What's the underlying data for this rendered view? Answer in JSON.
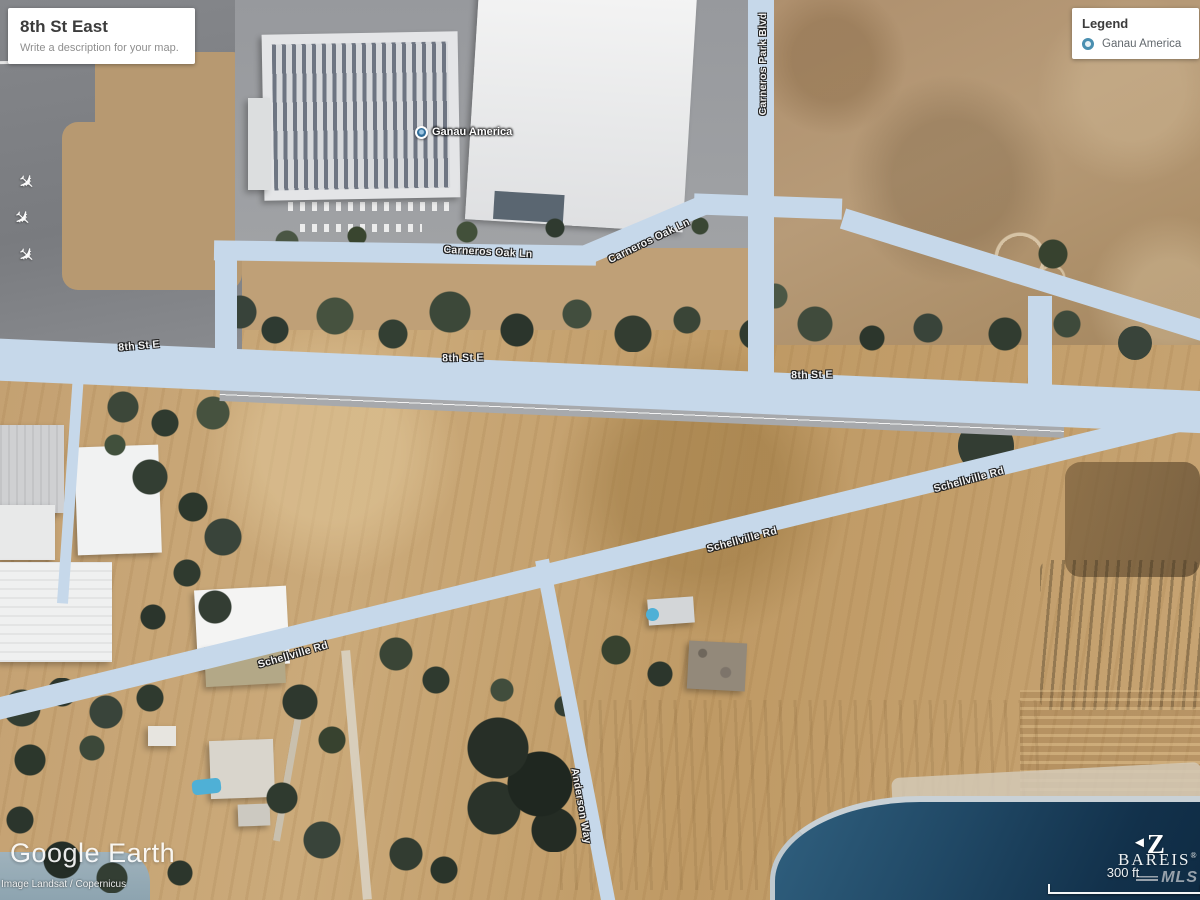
{
  "title_card": {
    "title": "8th St East",
    "subtitle": "Write a description for your map."
  },
  "legend": {
    "title": "Legend",
    "items": [
      {
        "label": "Ganau America",
        "marker_color": "#4a8fb0"
      }
    ]
  },
  "map": {
    "marker_label": "Ganau America",
    "road_labels": {
      "carneros_oak_w": "Carneros Oak Ln",
      "carneros_oak_e": "Carneros Oak Ln",
      "carneros_park_blvd": "Carneros Park Blvd",
      "eighth_w": "8th St E",
      "eighth_m": "8th St E",
      "eighth_e": "8th St E",
      "schellville_e": "Schellville Rd",
      "schellville_m": "Schellville Rd",
      "schellville_w": "Schellville Rd",
      "anderson": "Anderson Way"
    }
  },
  "watermark": {
    "brand": "Google Earth",
    "attribution": "Image Landsat / Copernicus"
  },
  "branding": {
    "compass_letter": "Z",
    "mls_name": "BAREIS",
    "mls_reg": "®",
    "mls_sub": "MLS"
  },
  "scale_bar": {
    "label": "300 ft"
  },
  "icons": {
    "airplane": "✈",
    "compass_arrow": "◄"
  },
  "colors": {
    "road_highlight": "#c6d8ea",
    "water": "#18374f",
    "legend_marker": "#4a8fb0"
  }
}
